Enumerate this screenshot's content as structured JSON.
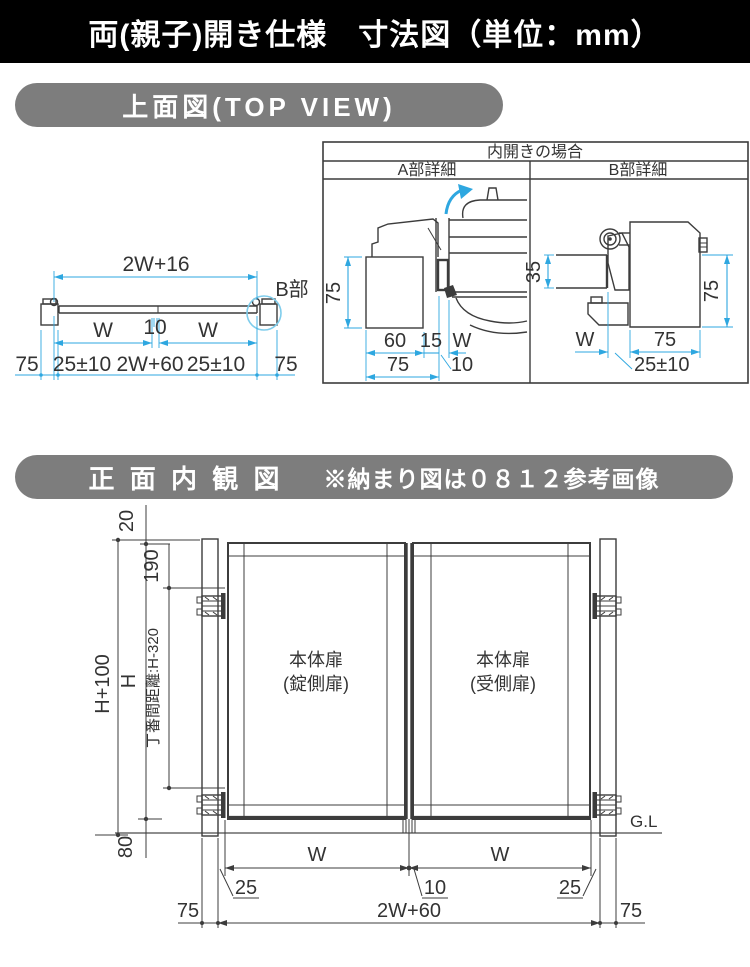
{
  "page_title": "両(親子)開き仕様　寸法図（単位：mm）",
  "top_view_section": {
    "heading": "上面図(TOP VIEW)",
    "labels": {
      "overall_width": "2W+16",
      "detail_ref": "B部",
      "leaf_w_left": "W",
      "center_gap": "10",
      "leaf_w_right": "W",
      "post_left": "75",
      "clearance_left": "25±10",
      "span": "2W+60",
      "clearance_right": "25±10",
      "post_right": "75"
    },
    "detail_panel": {
      "title": "内開きの場合",
      "a_heading": "A部詳細",
      "b_heading": "B部詳細",
      "a_labels": {
        "frame_height": "75",
        "d60": "60",
        "d15": "15",
        "w": "W",
        "d75": "75",
        "d10": "10"
      },
      "b_labels": {
        "d35": "35",
        "frame_height": "75",
        "w": "W",
        "d75": "75",
        "clearance": "25±10"
      }
    }
  },
  "front_view_section": {
    "heading": "正 面 内 観 図",
    "note": "※納まり図は０８１２参考画像",
    "labels": {
      "top_offset": "20",
      "hinge_top_offset": "190",
      "total_height": "H+100",
      "door_height": "H",
      "hinge_distance": "丁番間距離:H-320",
      "bottom_clearance": "80",
      "door_left_name": "本体扉",
      "door_left_sub": "(錠側扉)",
      "door_right_name": "本体扉",
      "door_right_sub": "(受側扉)",
      "ground": "G.L",
      "w_left": "W",
      "w_right": "W",
      "gap_left": "25",
      "gap_center": "10",
      "gap_right": "25",
      "post_left": "75",
      "span": "2W+60",
      "post_right": "75"
    }
  },
  "colors": {
    "dimension_blue": "#2ea7e0",
    "detail_circle_blue": "#7fcdec",
    "line_dark": "#3c3c3c",
    "bar_gray": "#7d7d7d",
    "header_bg": "#000000"
  }
}
